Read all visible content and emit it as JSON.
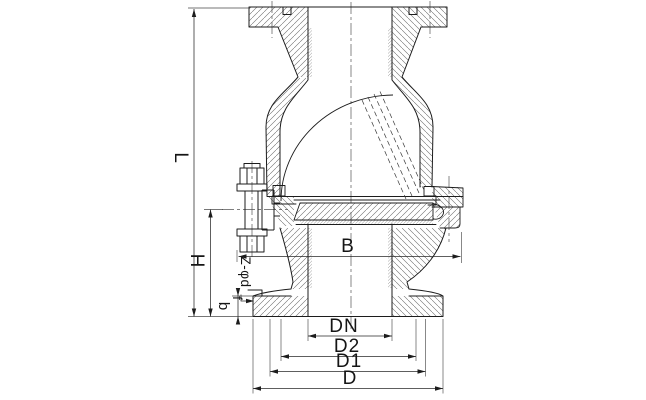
{
  "drawing": {
    "kind": "check-valve cross-section technical drawing",
    "labels": {
      "overall_length": "L",
      "height_to_pin": "H",
      "body_width": "B",
      "flange_thickness": "b",
      "raised_face_height": "f",
      "bolt_holes": "Z-φd",
      "nominal_bore": "DN",
      "raised_face_diameter": "D2",
      "bolt_circle_diameter": "D1",
      "flange_outer_diameter": "D"
    },
    "colors": {
      "outline": "#1c1c1c",
      "dimension": "#2a2a2a",
      "hatch": "#666666",
      "centerline": "#555555",
      "background": "#ffffff"
    }
  }
}
